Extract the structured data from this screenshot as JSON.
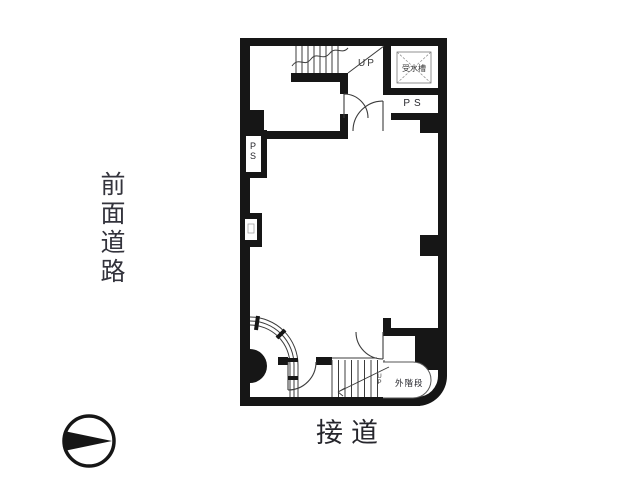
{
  "meta": {
    "type": "floor-plan"
  },
  "palette": {
    "background": "#ffffff",
    "wall_ink": "#161616",
    "thin_line": "#3c3c3c",
    "label_text": "#2e2e36"
  },
  "labels": {
    "front_road": "前面道路",
    "road": "接道",
    "stairs_up": "UP",
    "water_tank": "受水槽",
    "pipe_space_top": "PS",
    "pipe_space_left_chars": [
      "P",
      "S"
    ],
    "external_stairs": "外階段",
    "external_stairs_up_chars": [
      "U",
      "P"
    ]
  },
  "icons": {
    "compass": "north-arrow-circle"
  }
}
